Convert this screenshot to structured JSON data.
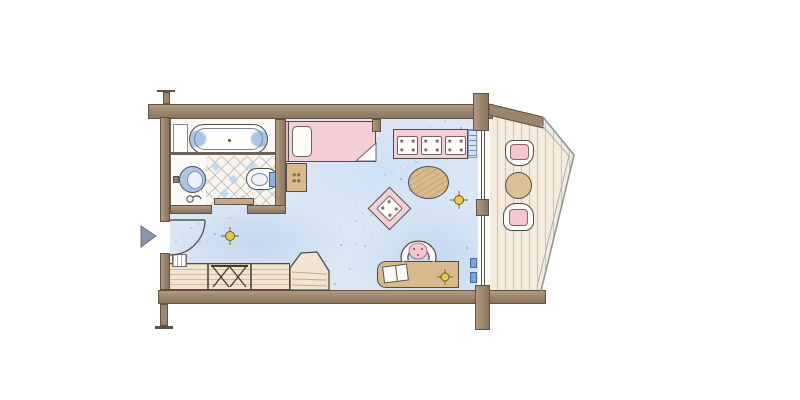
{
  "drawing": {
    "kind": "hand-drawn watercolor floor plan",
    "rooms": [
      {
        "id": "bathroom",
        "floor": "diagonal tiles with blue accents"
      },
      {
        "id": "entry-hall",
        "floor": "blue carpet"
      },
      {
        "id": "living-bedroom",
        "floor": "blue speckled carpet"
      },
      {
        "id": "balcony",
        "floor": "vertical wood planks, angled outline with railing"
      }
    ],
    "fixtures": [
      "bathtub",
      "washbasin",
      "wall-accessory",
      "toilet",
      "sliding-door",
      "radiator"
    ],
    "furniture": [
      "bed-with-pillow",
      "nightstand",
      "sofa-three-cushions",
      "oval-coffee-table",
      "armchair-rotated",
      "desk",
      "desk-chair",
      "open-book",
      "sideboard",
      "luggage-rack",
      "corner-cabinet",
      "entry-mat",
      "balcony-chair-north",
      "balcony-table",
      "balcony-chair-south"
    ],
    "symbols": {
      "entrance_arrow": 1,
      "door_swing_arc": 1,
      "ceiling_light_symbols": 3,
      "column_ticks": 4
    }
  },
  "palette": {
    "wall": "#99846c",
    "wall_outline": "#5f5346",
    "carpet_blue": "#dde8f5",
    "speckle_dark": "#7f95b8",
    "speckle_light": "#b7cde8",
    "furniture_pink": "#f6cfd6",
    "wood_tan": "#d9ba8e",
    "cabinet_cream": "#f1e4d2",
    "deck_cream": "#f5ebdc",
    "tile_blue": "#bdd3ee",
    "fixture_blue": "#a9c6e7",
    "light_symbol_gold": "#e7c94f",
    "entrance_arrow_gray": "#8b94a6",
    "railing_gray": "#8f969e"
  }
}
